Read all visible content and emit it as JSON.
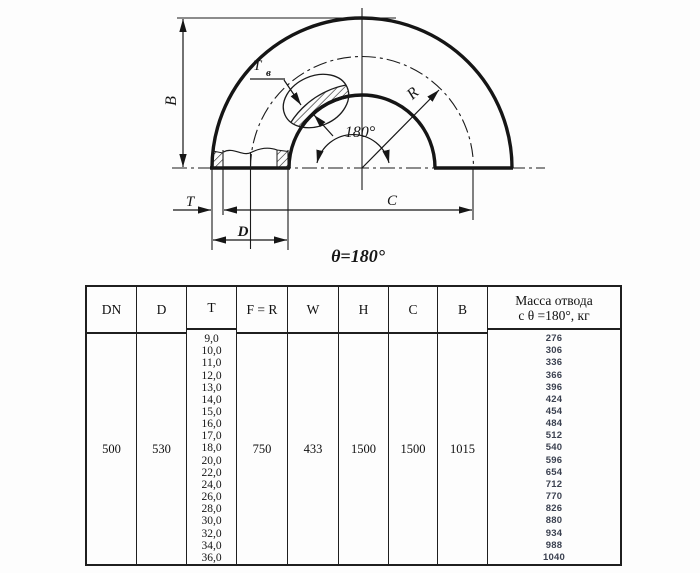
{
  "drawing": {
    "labels": {
      "b": "B",
      "t": "T",
      "d": "D",
      "c": "C",
      "r": "R",
      "tb_main": "T",
      "tb_sub": "в",
      "angle": "180°",
      "theta": "θ=180°"
    },
    "colors": {
      "line": "#1b1b1b"
    }
  },
  "table": {
    "headers": [
      "DN",
      "D",
      "T",
      "F = R",
      "W",
      "H",
      "C",
      "B"
    ],
    "mass_header_line1": "Масса отвода",
    "mass_header_line2": "с θ =180°, кг",
    "values": {
      "dn": "500",
      "d": "530",
      "f_r": "750",
      "w": "433",
      "h": "1500",
      "c": "1500",
      "b": "1015"
    },
    "t_values": [
      "9,0",
      "10,0",
      "11,0",
      "12,0",
      "13,0",
      "14,0",
      "15,0",
      "16,0",
      "17,0",
      "18,0",
      "20,0",
      "22,0",
      "24,0",
      "26,0",
      "28,0",
      "30,0",
      "32,0",
      "34,0",
      "36,0"
    ],
    "mass_values": [
      "276",
      "306",
      "336",
      "366",
      "396",
      "424",
      "454",
      "484",
      "512",
      "540",
      "596",
      "654",
      "712",
      "770",
      "826",
      "880",
      "934",
      "988",
      "1040"
    ],
    "colors": {
      "mass_text": "#3b4150"
    }
  }
}
